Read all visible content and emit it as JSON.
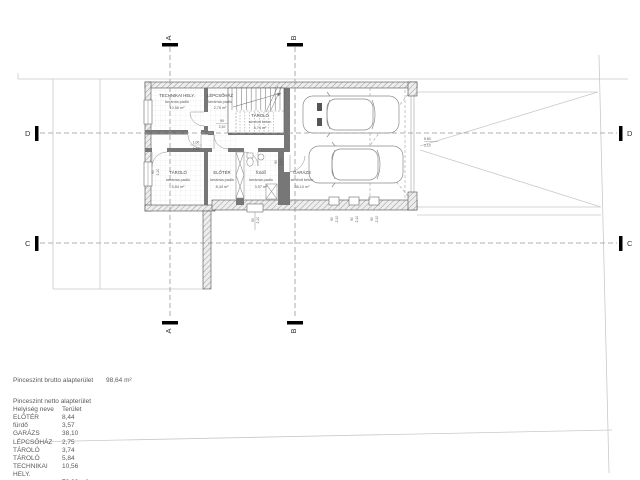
{
  "sections": {
    "a": "A",
    "b": "B",
    "c": "C",
    "d": "D"
  },
  "rooms": [
    {
      "name": "TECHNIKAI HELY.",
      "floor": "kerámia padló",
      "area": "10,56 m²"
    },
    {
      "name": "LÉPCSŐHÁZ",
      "floor": "kerámia padló",
      "area": "2,75 m²"
    },
    {
      "name": "TÁROLÓ",
      "floor": "simított beton",
      "area": "3,74 m²"
    },
    {
      "name": "TÁROLÓ",
      "floor": "kerámia padló",
      "area": "5,84 m²"
    },
    {
      "name": "ELŐTÉR",
      "floor": "kerámia padló",
      "area": "8,44 m²"
    },
    {
      "name": "fürdő",
      "floor": "kerámia padló",
      "area": "3,57 m²"
    },
    {
      "name": "GARÁZS",
      "floor": "simított beton",
      "area": "38,10 m²"
    }
  ],
  "dims": {
    "door_stair": {
      "w": "90",
      "h": "2,10"
    },
    "door_tech": {
      "w": "1,00",
      "h": "2,13"
    },
    "win_tarolo": {
      "w": "90",
      "h": "2,10"
    },
    "door_garage_hall": {
      "w": "90",
      "h": "2,10"
    },
    "exit_eloter": {
      "w": "90",
      "h": "2,10"
    },
    "niche1": {
      "w": "90",
      "h": "2,10"
    },
    "niche2": {
      "w": "90",
      "h": "2,10"
    },
    "niche3": {
      "w": "90",
      "h": "2,10"
    },
    "garage_door": {
      "w": "5,50",
      "h": "2,10"
    }
  },
  "summary": {
    "brutto_label": "Pinceszint brutto alapterület",
    "brutto_value": "98,64 m²",
    "netto_label": "Pinceszint netto alapterület",
    "col_room": "Helyiség neve",
    "col_area": "Terület",
    "rows": [
      {
        "name": "ELŐTÉR",
        "area": "8,44"
      },
      {
        "name": "fürdő",
        "area": "3,57"
      },
      {
        "name": "GARÁZS",
        "area": "38,10"
      },
      {
        "name": "LÉPCSŐHÁZ",
        "area": "2,75"
      },
      {
        "name": "TÁROLÓ",
        "area": "3,74"
      },
      {
        "name": "TÁROLÓ",
        "area": "5,84"
      },
      {
        "name": "TECHNIKAI HELY.",
        "area": "10,56"
      }
    ],
    "total": "73,00 m²"
  },
  "colors": {
    "wall_line": "#4d4d4d",
    "light_line": "#c9c9c9",
    "dash_line": "#979797",
    "marker_black": "#000000"
  }
}
